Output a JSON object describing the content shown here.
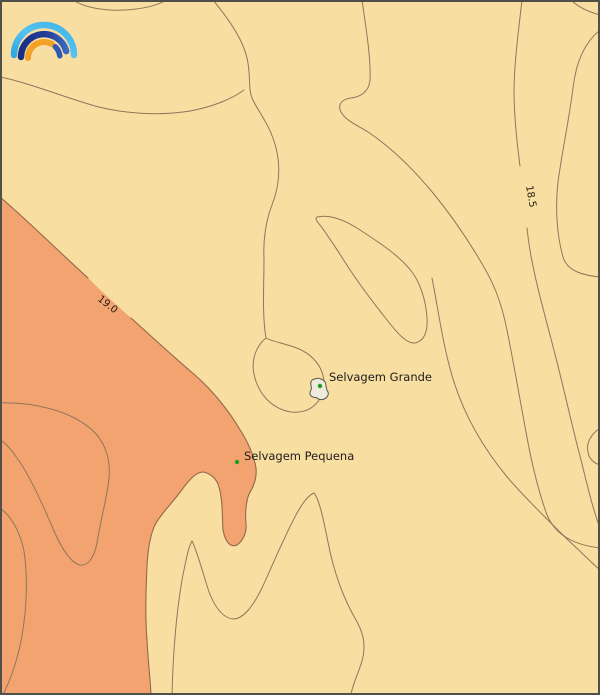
{
  "map": {
    "type": "filled-contour-weather-map",
    "contour_labels": {
      "warm": "19.0",
      "cool": "18.5"
    },
    "places": {
      "grande": "Selvagem Grande",
      "pequena": "Selvagem Pequena"
    },
    "colors": {
      "warm_region_fill": "#F3A370",
      "cool_region_fill": "#F9DEA2",
      "contour_line": "#8C785A",
      "warm_boundary_line": "#91684C",
      "island_fill": "#EFEBDC",
      "island_outline": "#54584A",
      "place_marker_green": "#1E9E1E",
      "label_text": "#1D1D1D",
      "frame": "#50504A"
    },
    "logo": {
      "description": "rainbow-arcs-weather-logo",
      "colors": {
        "outer_light_blue": "#3FB3E8",
        "mid_dark_blue": "#20368C",
        "mid_royal_blue": "#3A67C0",
        "inner_orange": "#F2A124"
      }
    }
  }
}
